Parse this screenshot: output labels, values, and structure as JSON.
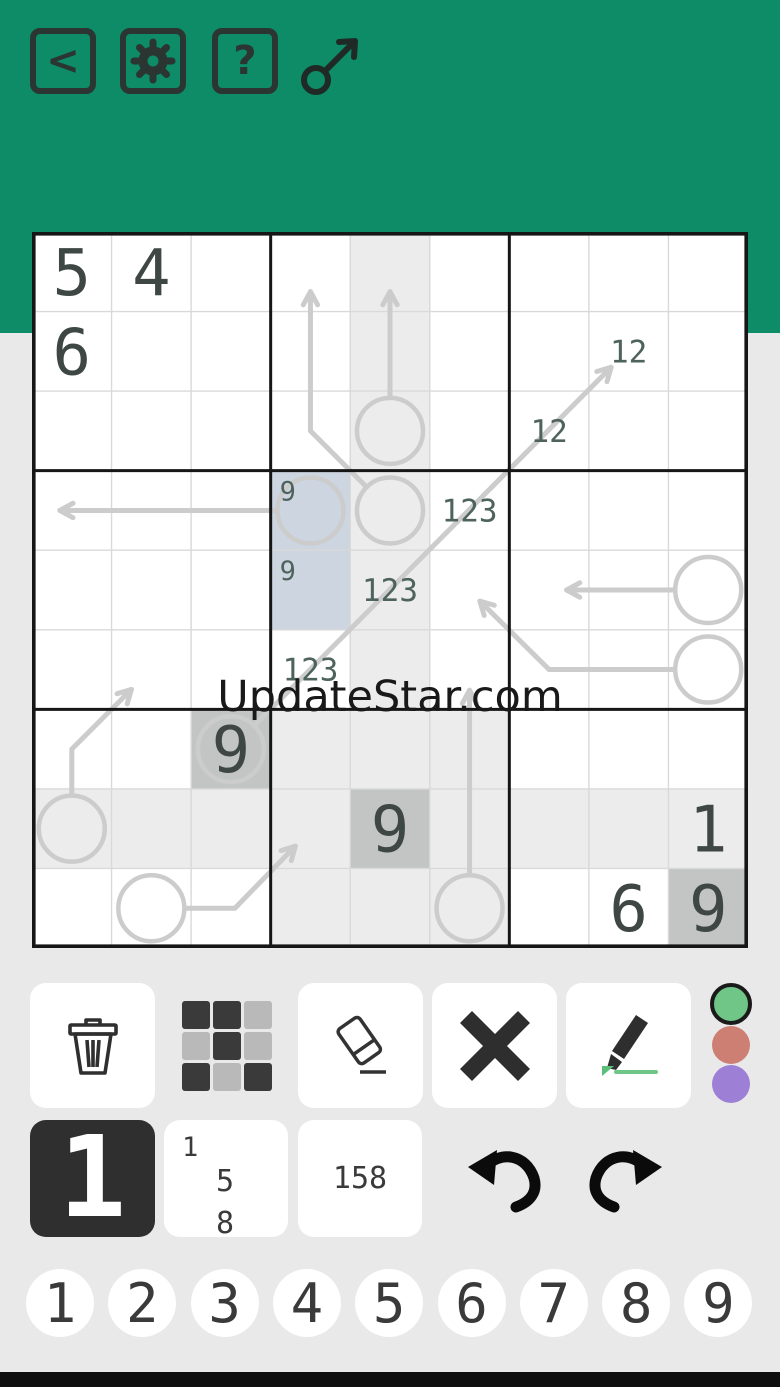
{
  "header": {
    "back_label": "<",
    "help_label": "?",
    "bg": "#0e8b67",
    "icon_color": "#2b3531"
  },
  "watermark": {
    "text": "UpdateStar.com"
  },
  "grid": {
    "colors": {
      "light": "#ececec",
      "dark": "#c3c4c4",
      "selected": "#cdd5e0",
      "arrow": "#cccccc",
      "given": "#3e4743",
      "pencil": "#4e635d",
      "line": "#d9d9d9",
      "border": "#161616"
    },
    "shaded_light": [
      [
        1,
        5
      ],
      [
        2,
        5
      ],
      [
        3,
        5
      ],
      [
        4,
        5
      ],
      [
        5,
        5
      ],
      [
        6,
        5
      ],
      [
        7,
        4
      ],
      [
        7,
        5
      ],
      [
        7,
        6
      ],
      [
        8,
        1
      ],
      [
        8,
        2
      ],
      [
        8,
        3
      ],
      [
        8,
        4
      ],
      [
        8,
        6
      ],
      [
        8,
        7
      ],
      [
        8,
        8
      ],
      [
        8,
        9
      ],
      [
        9,
        4
      ],
      [
        9,
        5
      ],
      [
        9,
        6
      ]
    ],
    "shaded_dark": [
      [
        7,
        3
      ],
      [
        8,
        5
      ],
      [
        9,
        9
      ]
    ],
    "selected_cells": [
      [
        4,
        4
      ],
      [
        5,
        4
      ]
    ],
    "givens": [
      [
        1,
        1,
        "5"
      ],
      [
        1,
        2,
        "4"
      ],
      [
        2,
        1,
        "6"
      ],
      [
        7,
        3,
        "9"
      ],
      [
        8,
        5,
        "9"
      ],
      [
        8,
        9,
        "1"
      ],
      [
        9,
        8,
        "6"
      ],
      [
        9,
        9,
        "9"
      ]
    ],
    "center_marks": [
      [
        2,
        8,
        "12"
      ],
      [
        3,
        7,
        "12"
      ],
      [
        4,
        6,
        "123"
      ],
      [
        5,
        5,
        "123"
      ],
      [
        6,
        4,
        "123"
      ]
    ],
    "corner_marks": [
      [
        4,
        4,
        "9"
      ],
      [
        5,
        4,
        "9"
      ]
    ],
    "arrows": [
      {
        "circle": [
          3,
          5
        ],
        "path": [
          [
            3,
            5
          ],
          [
            1.25,
            5
          ]
        ]
      },
      {
        "circle": [
          4,
          5
        ],
        "path": [
          [
            4,
            5
          ],
          [
            3,
            4
          ],
          [
            1.25,
            4
          ]
        ]
      },
      {
        "circle": [
          4,
          4
        ],
        "path": [
          [
            4,
            4
          ],
          [
            4,
            0.85
          ]
        ]
      },
      {
        "circle": [
          7,
          3
        ],
        "path": [
          [
            7,
            3
          ],
          [
            2.2,
            7.78
          ]
        ]
      },
      {
        "circle": [
          5,
          9
        ],
        "path": [
          [
            5,
            9
          ],
          [
            5,
            7.22
          ]
        ]
      },
      {
        "circle": [
          6,
          9
        ],
        "path": [
          [
            6,
            9
          ],
          [
            6,
            7
          ],
          [
            5.14,
            6.13
          ]
        ]
      },
      {
        "circle": [
          8,
          1
        ],
        "path": [
          [
            8,
            1
          ],
          [
            7,
            1
          ],
          [
            6.25,
            1.75
          ]
        ]
      },
      {
        "circle": [
          9,
          2
        ],
        "path": [
          [
            9,
            2
          ],
          [
            9,
            3.05
          ],
          [
            8.22,
            3.81
          ]
        ]
      },
      {
        "circle": [
          9,
          6
        ],
        "path": [
          [
            9,
            6
          ],
          [
            6.26,
            6
          ]
        ]
      }
    ]
  },
  "toolbar": {
    "buttons": [
      "delete",
      "color-grid",
      "eraser",
      "cross",
      "marker"
    ],
    "grid_icon_pattern": [
      [
        "dark",
        "dark",
        "light"
      ],
      [
        "light",
        "dark",
        "light"
      ],
      [
        "dark",
        "light",
        "dark"
      ]
    ],
    "grid_icon_colors": {
      "dark": "#3a3a3a",
      "light": "#b9b9b9"
    },
    "dots": [
      {
        "name": "green",
        "color": "#6fc687",
        "selected": true
      },
      {
        "name": "red",
        "color": "#cd7f73",
        "selected": false
      },
      {
        "name": "purple",
        "color": "#9e7fd6",
        "selected": false
      }
    ],
    "mode_normal_label": "1",
    "corner_marks": {
      "tl": "1",
      "mid": "5",
      "bot": "8"
    },
    "mode_center_label": "158"
  },
  "digit_pad": {
    "digits": [
      "1",
      "2",
      "3",
      "4",
      "5",
      "6",
      "7",
      "8",
      "9"
    ]
  }
}
